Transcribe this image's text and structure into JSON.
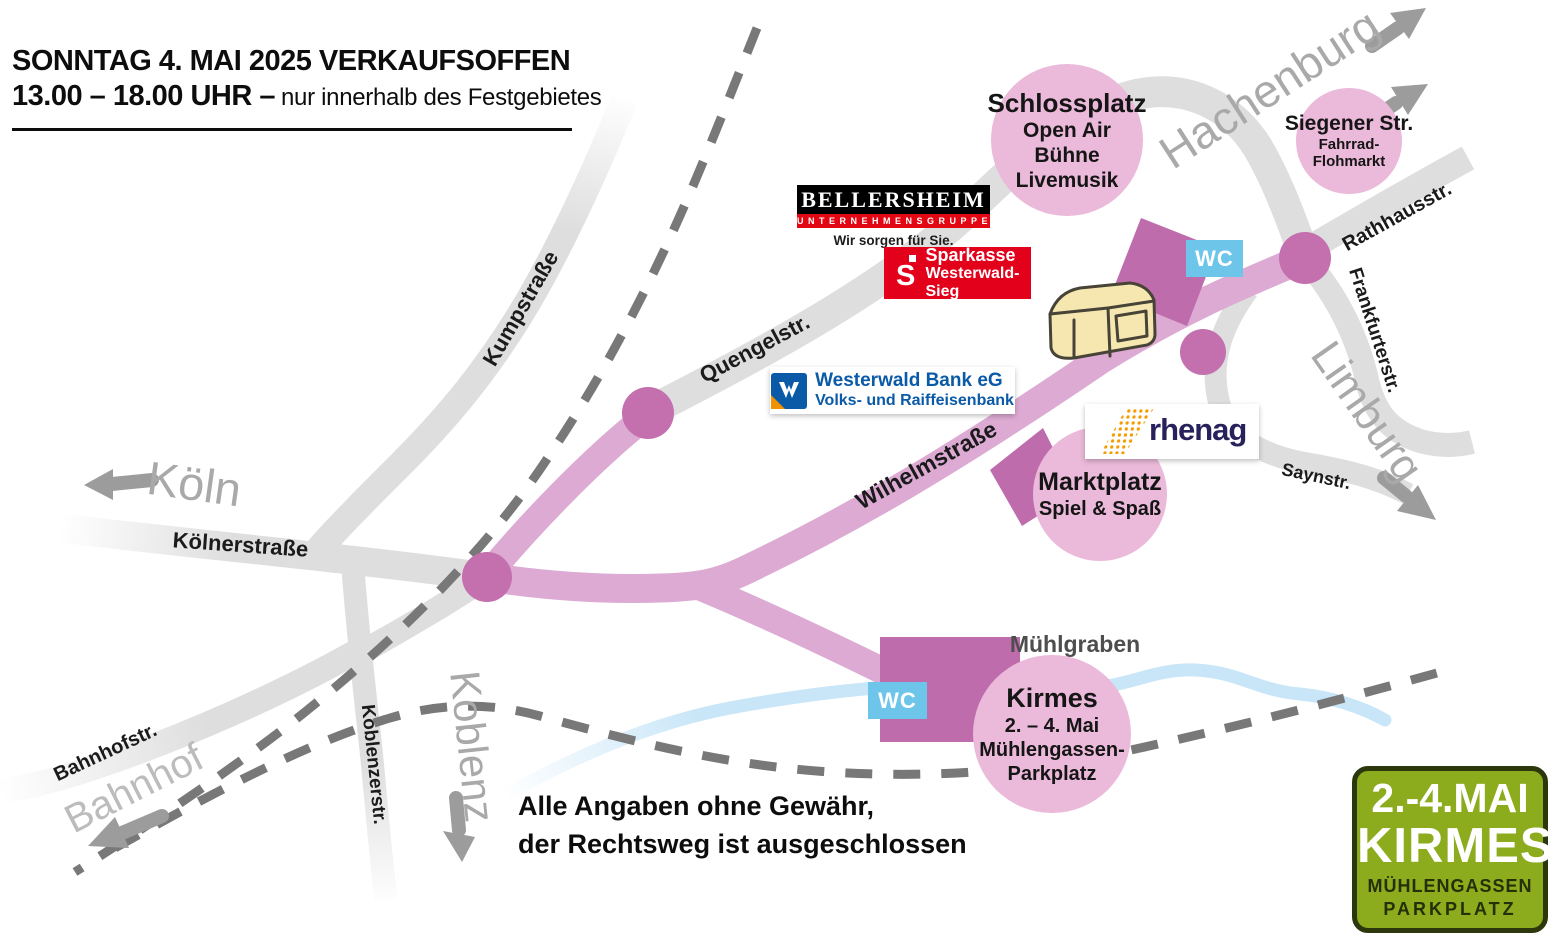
{
  "header": {
    "line1": "SONNTAG 4. MAI 2025 VERKAUFSOFFEN",
    "line2_bold": "13.00 – 18.00 UHR –",
    "line2_rest": "nur innerhalb des Festgebietes"
  },
  "disclaimer": {
    "line1": "Alle Angaben ohne Gewähr,",
    "line2": "der Rechtsweg ist ausgeschlossen"
  },
  "streets": {
    "kumpstrasse": "Kumpstraße",
    "quengelstr": "Quengelstr.",
    "koelnerstrasse": "Kölnerstraße",
    "bahnhofstr": "Bahnhofstr.",
    "koblenzerstr": "Koblenzerstr.",
    "wilhelmstrasse": "Wilhelmstraße",
    "rathhausstr": "Rathhausstr.",
    "frankfurterstr": "Frankfurterstr.",
    "saynstr": "Saynstr.",
    "muehlgraben": "Mühlgraben"
  },
  "directions": {
    "koeln": "Köln",
    "koblenz": "Koblenz",
    "bahnhof": "Bahnhof",
    "hachenburg": "Hachenburg",
    "limburg": "Limburg"
  },
  "venues": {
    "schlossplatz": {
      "title": "Schlossplatz",
      "line1": "Open Air Bühne",
      "line2": "Livemusik"
    },
    "siegener": {
      "title": "Siegener Str.",
      "line1": "Fahrrad-",
      "line2": "Flohmarkt"
    },
    "marktplatz": {
      "title": "Marktplatz",
      "line1": "Spiel & Spaß"
    },
    "kirmes": {
      "title": "Kirmes",
      "line1": "2. – 4. Mai",
      "line2": "Mühlengassen-",
      "line3": "Parkplatz"
    }
  },
  "wc_label": "WC",
  "logos": {
    "bellersheim": {
      "name": "BELLERSHEIM",
      "sub": "UNTERNEHMENSGRUPPE",
      "tagline": "Wir sorgen für Sie."
    },
    "sparkasse": {
      "symbol": "S",
      "line1": "Sparkasse",
      "line2": "Westerwald-Sieg"
    },
    "westerwaldbank": {
      "line1": "Westerwald Bank eG",
      "line2": "Volks- und Raiffeisenbank"
    },
    "rhenag": {
      "name": "rhenag"
    }
  },
  "badge": {
    "line1": "2.-4.MAI",
    "line2": "KIRMES",
    "line3": "MÜHLENGASSEN",
    "line4": "PARKPLATZ"
  },
  "colors": {
    "street_gray": "#dedede",
    "festival_road_pink": "#dcaad3",
    "node_pink": "#c46fae",
    "area_purple": "#bf6cac",
    "venue_circle_pink": "#ebb9d9",
    "wc_blue": "#6ec5ea",
    "stream_blue": "#c8e6f8",
    "railway_gray": "#787878",
    "direction_gray": "#a9a9a9",
    "badge_green": "#8cab1d",
    "badge_dark": "#2c370c",
    "sparkasse_red": "#e3001b",
    "bellersheim_red": "#e30613",
    "bank_blue": "#0a5aa8",
    "rhenag_navy": "#27215c",
    "rhenag_orange": "#f59b00",
    "building_cream": "#f6e7b1"
  }
}
